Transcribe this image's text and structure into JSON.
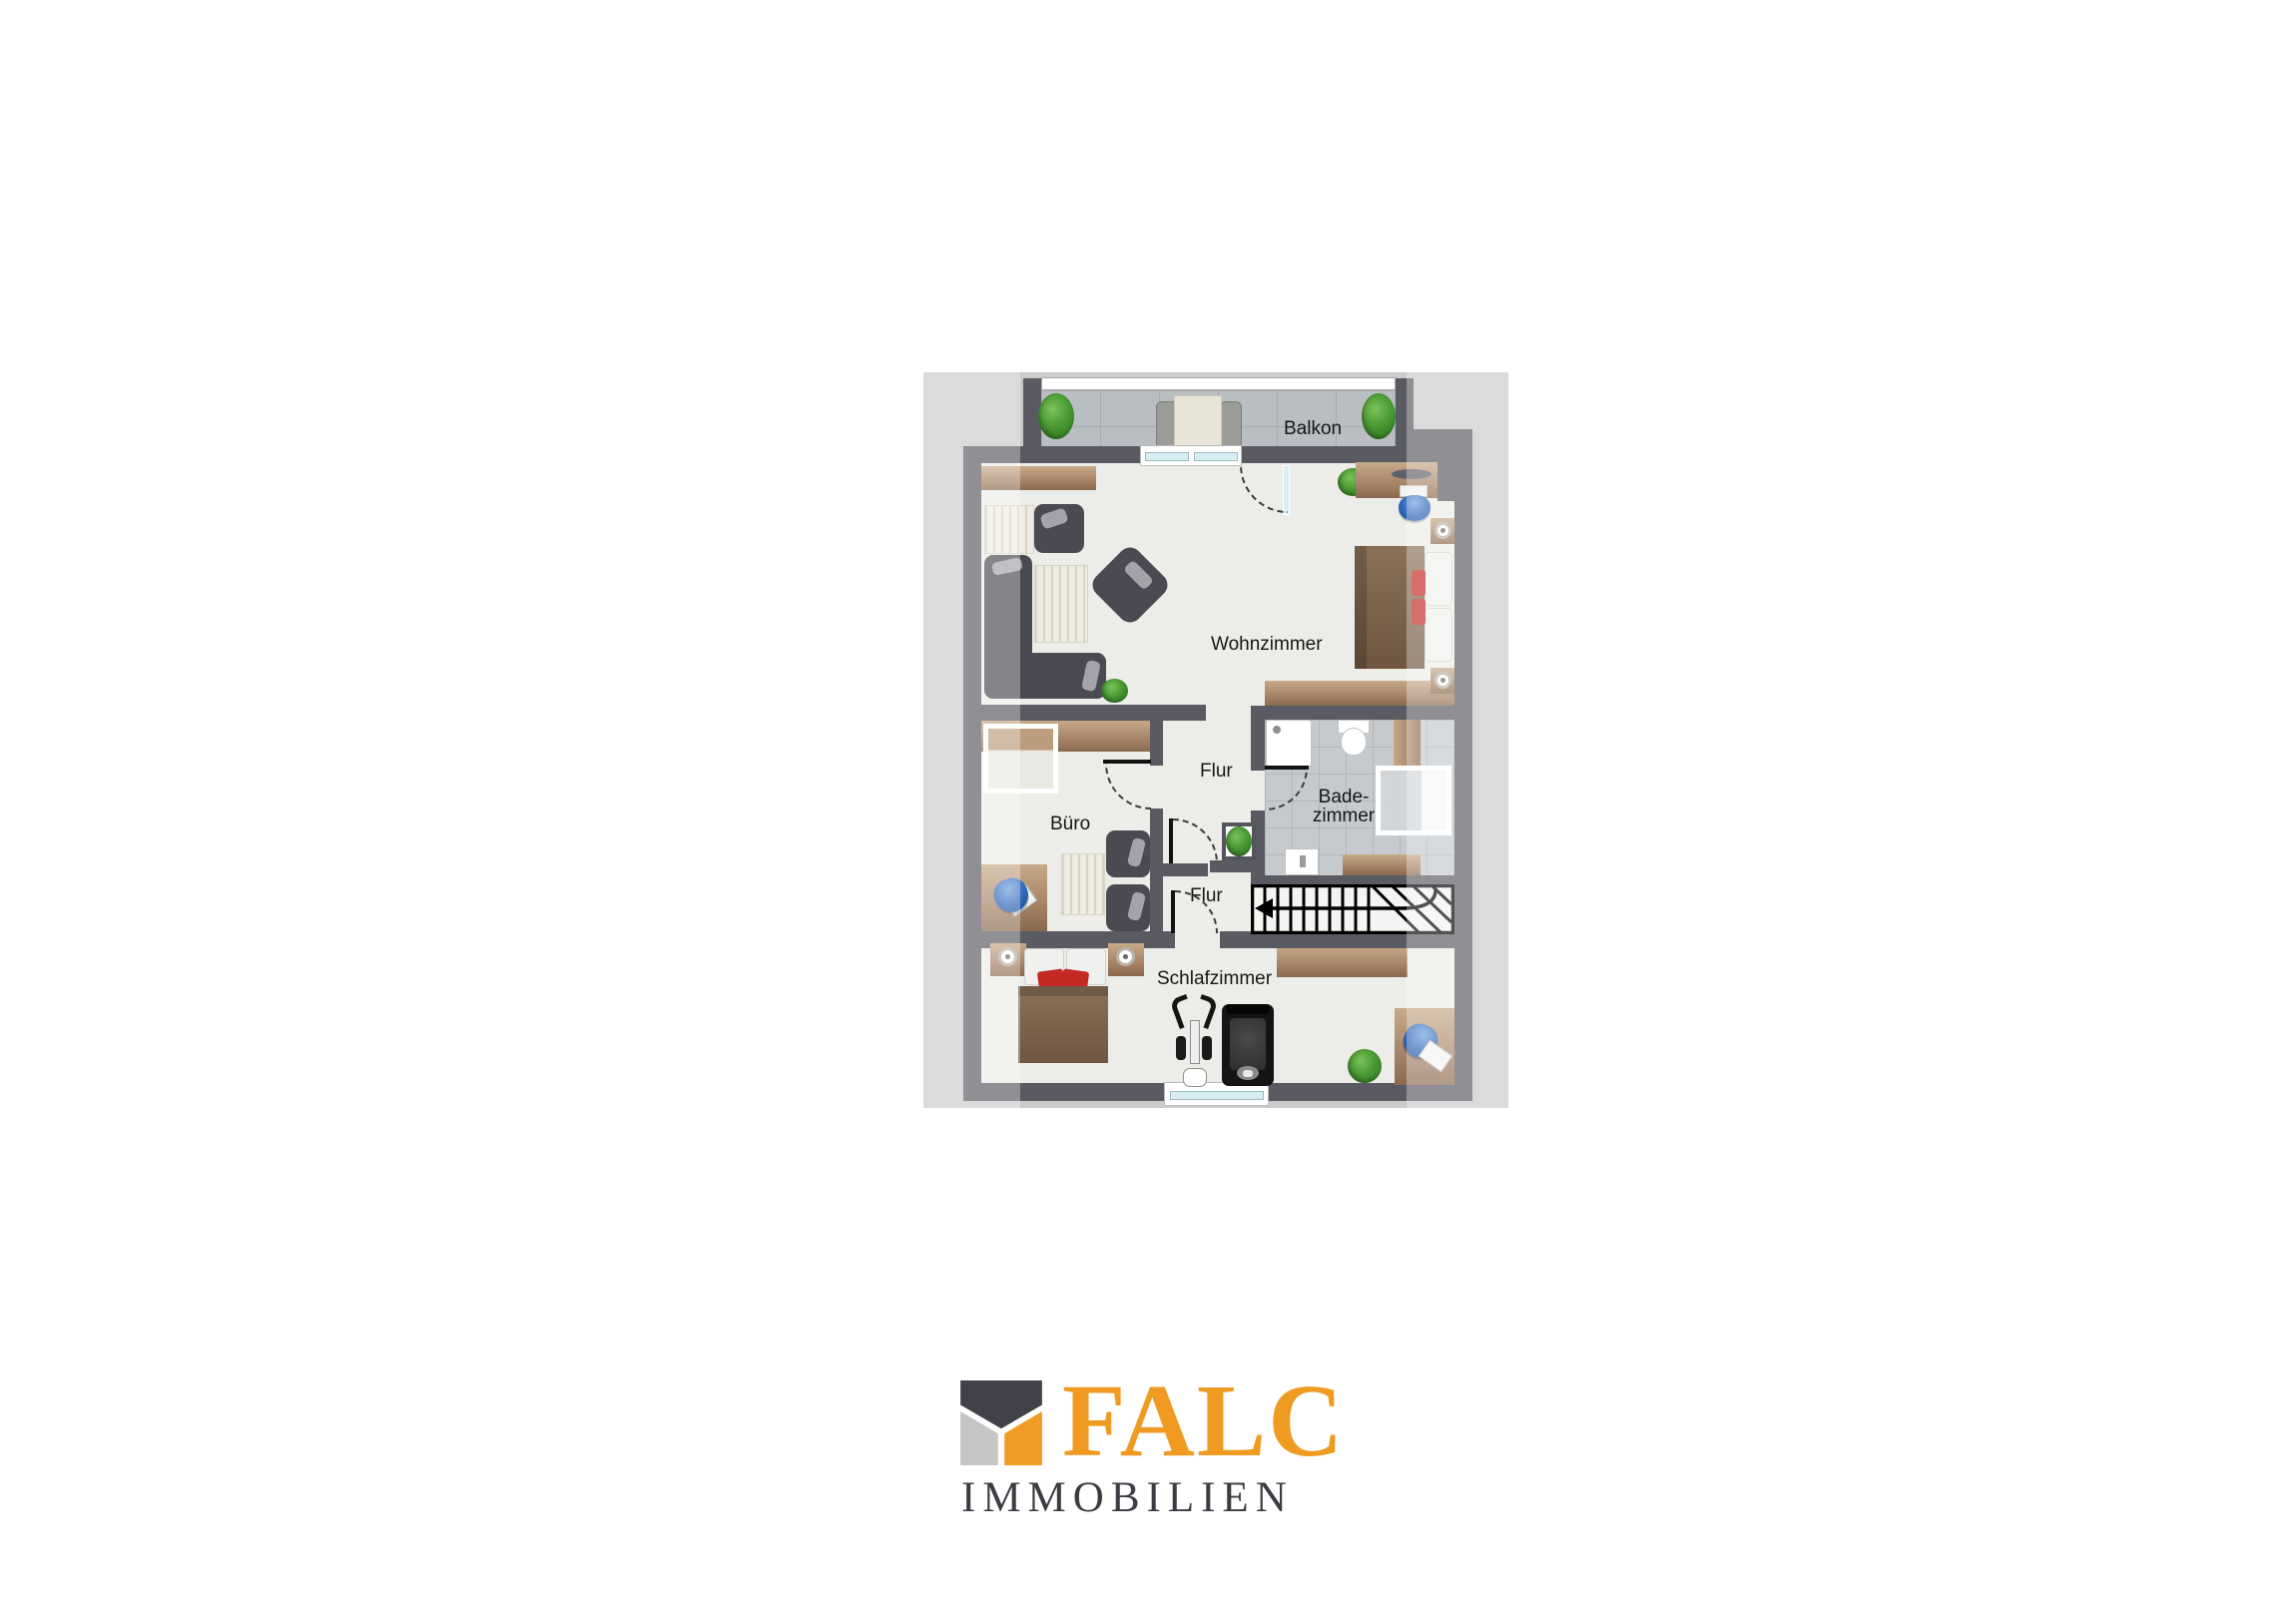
{
  "floorplan": {
    "labels": {
      "balcony": "Balkon",
      "living": "Wohnzimmer",
      "hall_upper": "Flur",
      "bath_line1": "Bade-",
      "bath_line2": "zimmer",
      "office": "Büro",
      "hall_lower": "Flur",
      "bedroom": "Schlafzimmer"
    },
    "colors": {
      "wall": "#5A5A62",
      "floor": "#ECECE8",
      "background_gray": "#CBCBCB",
      "balcony_tile": "#B9BEC3",
      "bath_tile": "#C6CACD",
      "wood": "#A8866A",
      "accent_red": "#C32A24",
      "accent_blue": "#2E66B8",
      "plant_green": "#4A9A33"
    }
  },
  "logo": {
    "brand": "FALC",
    "subtitle": "IMMOBILIEN",
    "brand_color": "#EF9B22",
    "subtitle_color": "#3C3C44",
    "icon_colors": {
      "dark": "#414149",
      "gray": "#C5C5C5",
      "orange": "#F09C22"
    }
  }
}
